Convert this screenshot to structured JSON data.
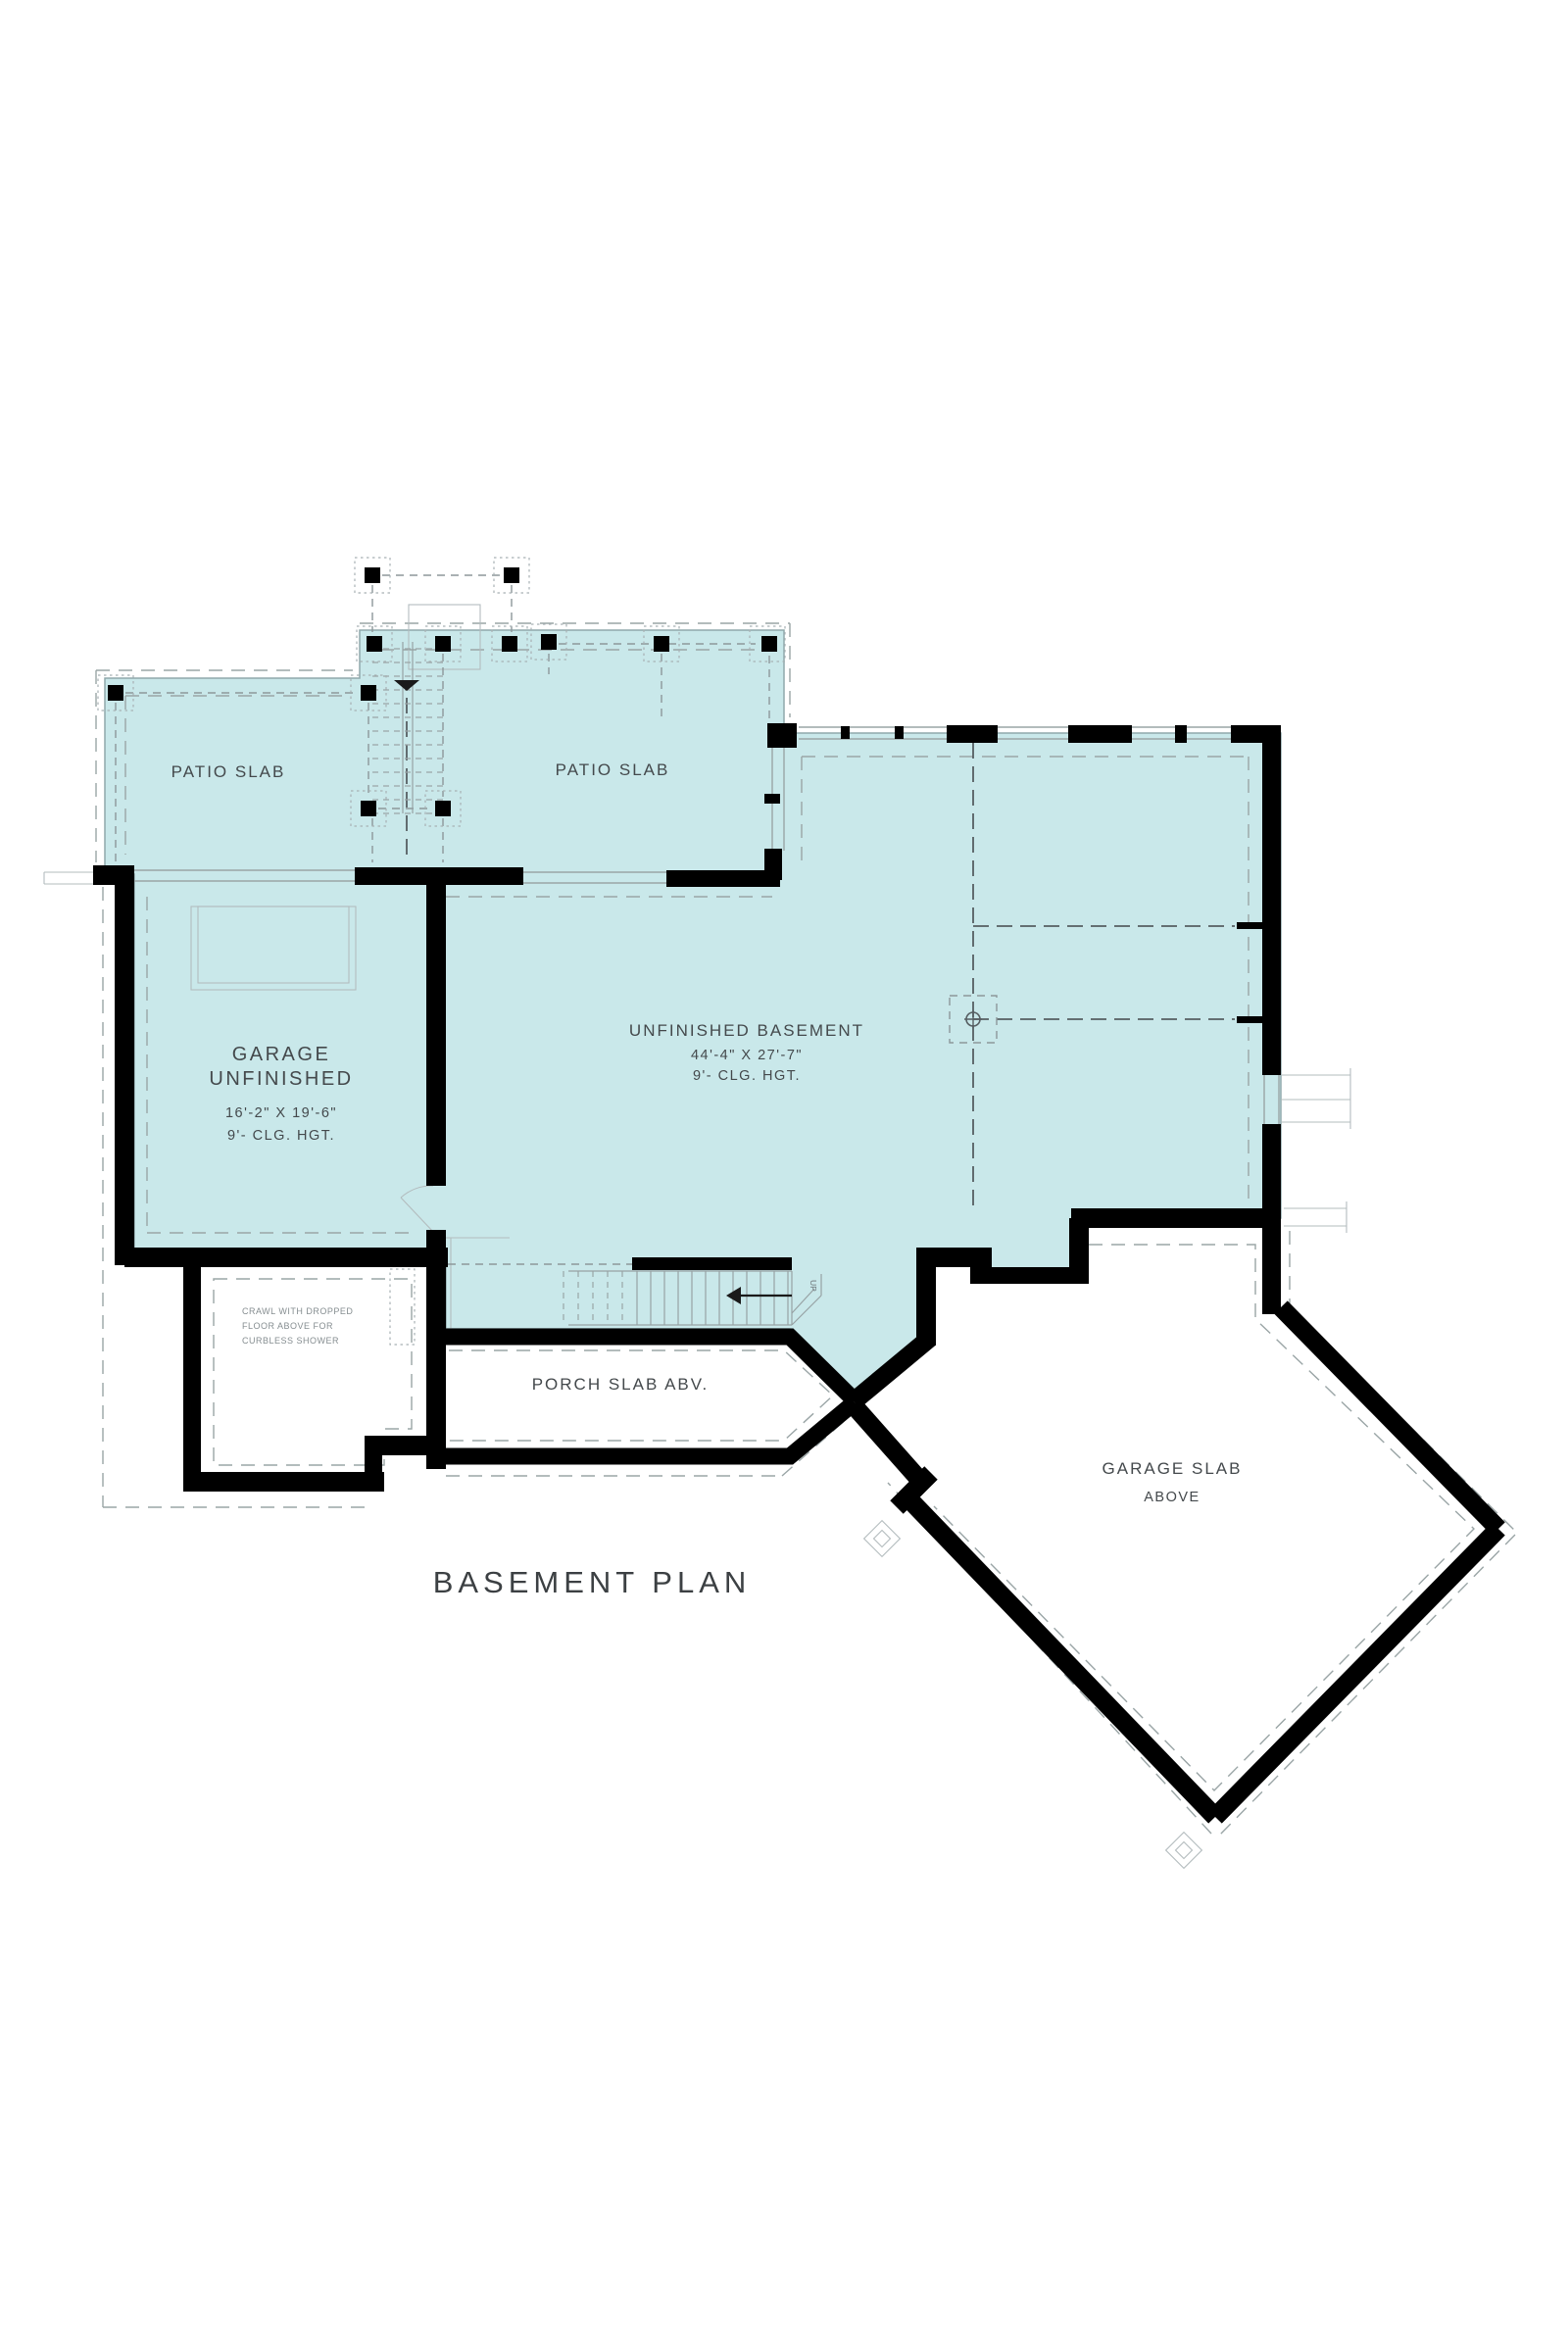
{
  "title": "BASEMENT PLAN",
  "rooms": {
    "patio_left": {
      "label": "PATIO SLAB"
    },
    "patio_right": {
      "label": "PATIO SLAB"
    },
    "garage": {
      "line1": "GARAGE",
      "line2": "UNFINISHED",
      "dims": "16'-2\" X 19'-6\"",
      "ceiling": "9'- CLG. HGT."
    },
    "basement": {
      "label": "UNFINISHED BASEMENT",
      "dims": "44'-4\" X 27'-7\"",
      "ceiling": "9'- CLG. HGT."
    },
    "crawl": {
      "line1": "CRAWL WITH DROPPED",
      "line2": "FLOOR ABOVE FOR",
      "line3": "CURBLESS SHOWER"
    },
    "porch": {
      "label": "PORCH SLAB ABV."
    },
    "garage_slab": {
      "line1": "GARAGE SLAB",
      "line2": "ABOVE"
    },
    "stairs": {
      "up_label": "UP"
    }
  },
  "colors": {
    "slab_fill": "#c9e8ea",
    "wall": "#000000",
    "line": "#9aa5a6",
    "text": "#44494c"
  }
}
